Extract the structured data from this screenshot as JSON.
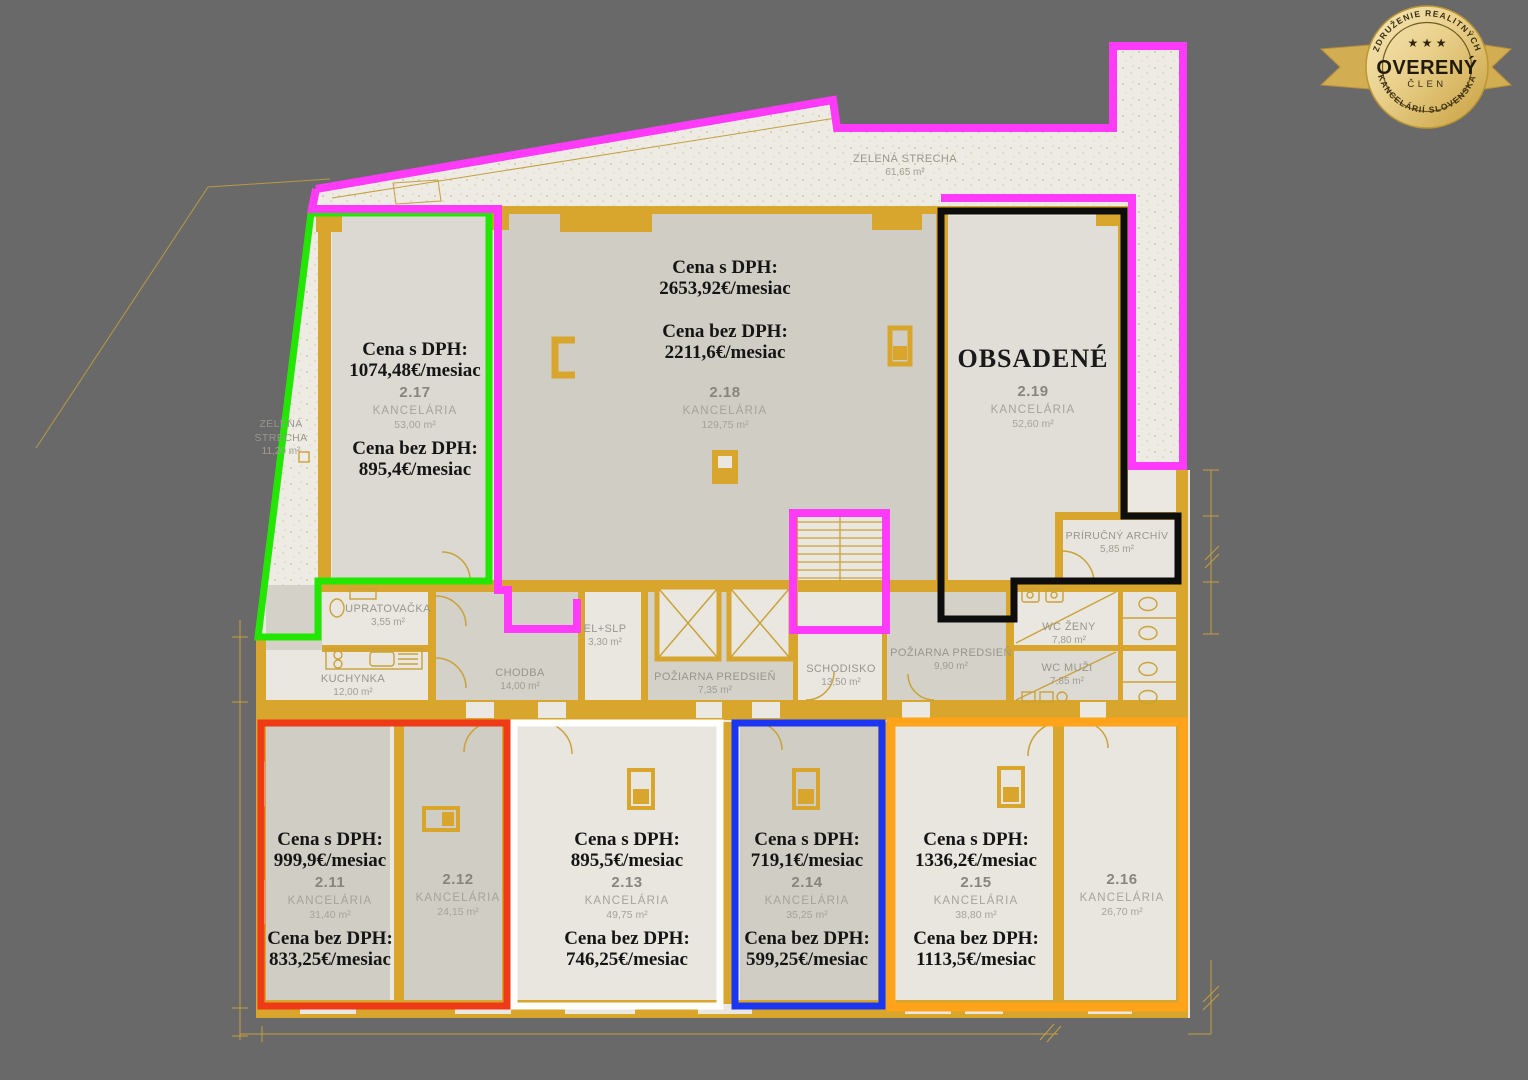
{
  "badge": {
    "arc_top": "ZDRUŽENIE REALITNÝCH",
    "stars": "★ ★ ★",
    "title": "OVERENÝ",
    "subtitle": "ČLEN",
    "arc_bottom": "KANCELÁRIÍ SLOVENSKA"
  },
  "labels": {
    "price_with_vat": "Cena s DPH:",
    "price_without_vat": "Cena bez DPH:",
    "room_type": "KANCELÁRIA"
  },
  "roof_top": {
    "name": "ZELENÁ STRECHA",
    "area": "61,65 m²"
  },
  "roof_left": {
    "name_line1": "ZELENÁ",
    "name_line2": "STRECHA",
    "area": "11,20 m²"
  },
  "units": {
    "u217": {
      "price_with_vat": "1074,48€/mesiac",
      "number": "2.17",
      "area": "53,00 m²",
      "price_without_vat": "895,4€/mesiac"
    },
    "u218": {
      "price_with_vat": "2653,92€/mesiac",
      "number": "2.18",
      "area": "129,75 m²",
      "price_without_vat": "2211,6€/mesiac"
    },
    "u219": {
      "status": "OBSADENÉ",
      "number": "2.19",
      "area": "52,60 m²"
    },
    "u211": {
      "price_with_vat": "999,9€/mesiac",
      "number": "2.11",
      "area": "31,40 m²",
      "price_without_vat": "833,25€/mesiac"
    },
    "u212": {
      "number": "2.12",
      "area": "24,15 m²"
    },
    "u213": {
      "price_with_vat": "895,5€/mesiac",
      "number": "2.13",
      "area": "49,75 m²",
      "price_without_vat": "746,25€/mesiac"
    },
    "u214": {
      "price_with_vat": "719,1€/mesiac",
      "number": "2.14",
      "area": "35,25 m²",
      "price_without_vat": "599,25€/mesiac"
    },
    "u215": {
      "price_with_vat": "1336,2€/mesiac",
      "number": "2.15",
      "area": "38,80 m²",
      "price_without_vat": "1113,5€/mesiac"
    },
    "u216": {
      "number": "2.16",
      "area": "26,70 m²"
    }
  },
  "rooms": {
    "upratovacka": {
      "name": "UPRATOVAČKA",
      "area": "3,55 m²"
    },
    "kuchynka": {
      "name": "KUCHYNKA",
      "area": "12,00 m²"
    },
    "chodba": {
      "name": "CHODBA",
      "area": "14,00 m²"
    },
    "el_slp": {
      "name": "EL+SLP",
      "area": "3,30 m²"
    },
    "poziarna_predsien_1": {
      "name": "POŽIARNA PREDSIEŇ",
      "area": "7,35 m²"
    },
    "schodisko": {
      "name": "SCHODISKO",
      "area": "13,50 m²"
    },
    "poziarna_predsien_2": {
      "name": "POŽIARNA PREDSIEŇ",
      "area": "9,90 m²"
    },
    "wc_zeny": {
      "name": "WC ŽENY",
      "area": "7,80 m²"
    },
    "wc_muzi": {
      "name": "WC MUŽI",
      "area": "7,85 m²"
    },
    "prirucny_archiv": {
      "name": "PRÍRUČNÝ ARCHÍV",
      "area": "5,85 m²"
    }
  },
  "colors": {
    "background": "#696969",
    "gold": "#d8a62c",
    "magenta": "#ff3af8",
    "green": "#23e702",
    "black": "#0d0d0d",
    "red": "#ee3a16",
    "white": "#ffffff",
    "blue": "#1b36f2",
    "orange": "#ffa31a"
  }
}
